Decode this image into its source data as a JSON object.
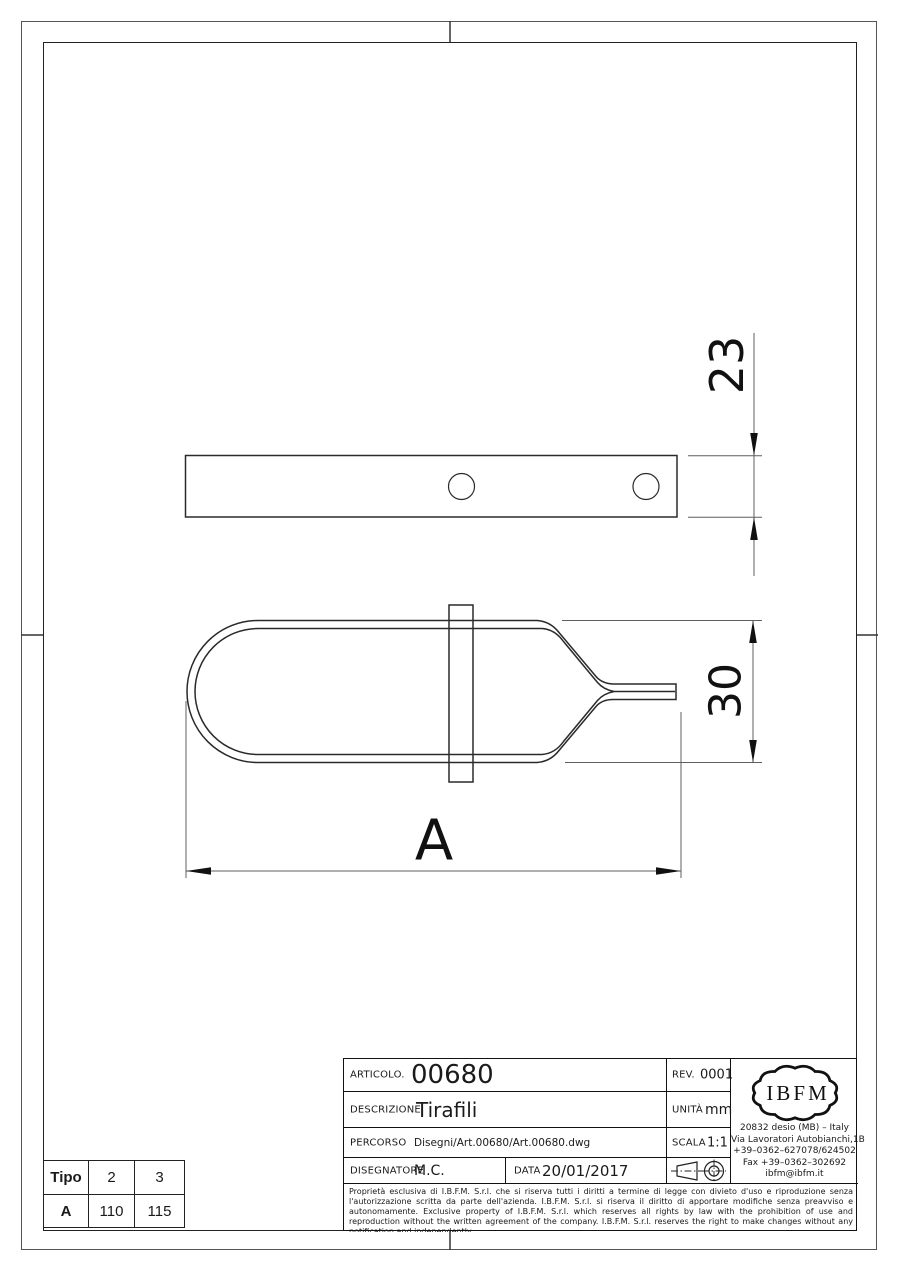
{
  "sheet": {
    "dim_labels": {
      "bar_width": "23",
      "loop_height": "30",
      "overall_length": "A"
    }
  },
  "title_block": {
    "articolo_label": "ARTICOLO.",
    "articolo_value": "00680",
    "rev_label": "REV.",
    "rev_value": "0001",
    "descrizione_label": "DESCRIZIONE",
    "descrizione_value": "Tirafili",
    "unita_label": "UNITÀ",
    "unita_value": "mm",
    "percorso_label": "PERCORSO",
    "percorso_value": "Disegni/Art.00680/Art.00680.dwg",
    "scala_label": "SCALA",
    "scala_value": "1:1",
    "disegnatore_label": "DISEGNATORE",
    "disegnatore_value": "M.C.",
    "data_label": "DATA",
    "data_value": "20/01/2017",
    "logo_text": "IBFM",
    "address_lines": [
      "20832 desio (MB) – Italy",
      "Via Lavoratori Autobianchi,1B",
      "+39–0362–627078/624502",
      "Fax +39–0362–302692",
      "ibfm@ibfm.it"
    ],
    "legal_text": "Proprietà esclusiva di I.B.F.M. S.r.l. che si riserva tutti i diritti a termine di legge con divieto d'uso e riproduzione senza l'autorizzazione scritta da parte dell'azienda. I.B.F.M. S.r.l. si riserva il diritto di apportare modifiche senza preavviso e autonomamente. Exclusive property of I.B.F.M. S.r.l. which reserves all rights by law with the prohibition of use and reproduction without the written agreement of the company. I.B.F.M. S.r.l. reserves the right to make changes without any notification and independently."
  },
  "size_table": {
    "header": [
      "Tipo",
      "2",
      "3"
    ],
    "row_a": [
      "A",
      "110",
      "115"
    ]
  },
  "colors": {
    "line": "#1a1a1a",
    "dim_line": "#5f5f5f",
    "background": "#ffffff"
  }
}
